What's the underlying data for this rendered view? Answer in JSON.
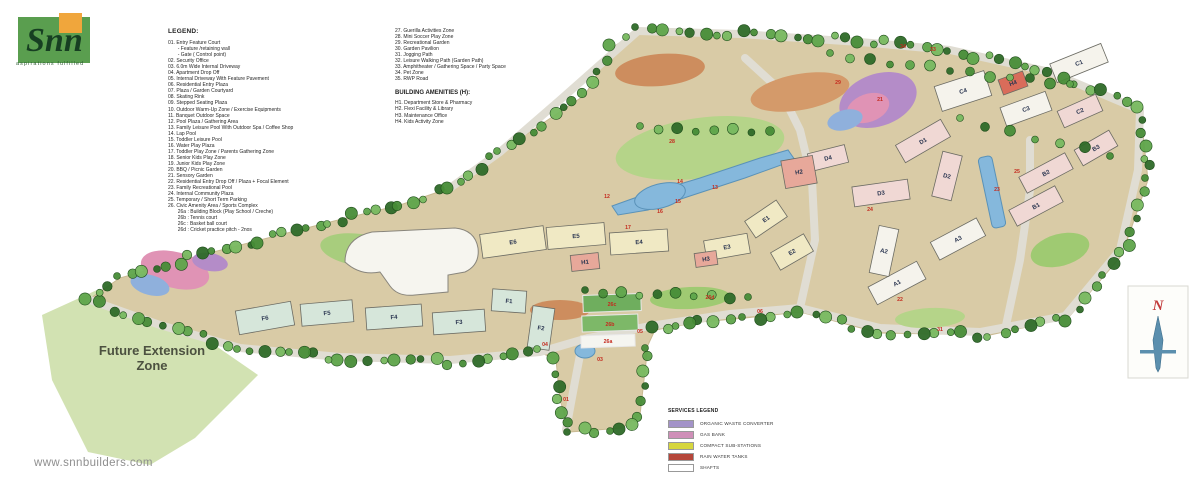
{
  "brand": {
    "name": "Snn",
    "tagline": "aspirations fulfilled",
    "website": "www.snnbuilders.com",
    "green": "#5a9e4f",
    "orange": "#f0a63c"
  },
  "legend": {
    "title": "LEGEND:",
    "col1": [
      "01. Entry Feature Court",
      "       - Feature /retaining wall",
      "       - Gate ( Control point)",
      "02. Security Office",
      "03. 6.0m Wide Internal Driveway",
      "04. Apartment Drop Off",
      "05. Internal Driveway With Feature Pavement",
      "06. Residential Entry Plaza",
      "07. Plaza / Garden Courtyard",
      "08. Skating Rink",
      "09. Stepped Seating Plaza",
      "10. Outdoor Warm-Up Zone / Exercise Equipments",
      "11. Banquet Outdoor Space",
      "12. Pool Plaza / Gathering Area",
      "13. Family Leisure Pool With Outdoor Spa / Coffee Shop",
      "14. Lap Pool",
      "15. Toddler Leisure Pool",
      "16. Water Play Plaza",
      "17. Toddler Play Zone / Parents Gathering Zone",
      "18. Senior Kids Play Zone",
      "19. Junior Kids Play Zone",
      "20. BBQ / Picnic Garden",
      "21. Sensory Garden",
      "22. Residential Entry Drop Off / Plaza + Focal Element",
      "23. Family Recreational Pool",
      "24. Internal Community Plaza",
      "25. Temporary / Short Term Parking",
      "26. Civic Amenity Area / Sports Complex",
      "       26a : Building Block (Play School / Creche)",
      "       26b : Tennis court",
      "       26c : Basket ball court",
      "       26d : Cricket practice pitch - 2nos"
    ],
    "col2": [
      "27. Guerilla Activities Zone",
      "28. Mini Soccer Play Zone",
      "29. Recreational Garden",
      "30. Garden Pavilion",
      "31. Jogging Path",
      "32. Leisure Walking Path (Garden Path)",
      "33. Amphitheater / Gathering Space / Party Space",
      "34. Pet Zone",
      "35. RWP Road"
    ],
    "amenities_title": "BUILDING AMENITIES (H):",
    "amenities": [
      "H1. Department Store & Pharmacy",
      "H2. Flexi Facility & Library",
      "H3. Maintenance Office",
      "H4. Kids Activity Zone"
    ]
  },
  "services_legend": {
    "title": "SERVICES LEGEND",
    "items": [
      {
        "label": "ORGANIC WASTE CONVERTER",
        "color": "#a393c8"
      },
      {
        "label": "GAS BANK",
        "color": "#cf8fb8"
      },
      {
        "label": "COMPACT SUB-STATIONS",
        "color": "#d6d63e"
      },
      {
        "label": "RAIN WATER TANKS",
        "color": "#b5463a"
      },
      {
        "label": "SHAFTS",
        "color": "#ffffff"
      }
    ]
  },
  "map": {
    "future_zone_label": [
      "Future Extension",
      "Zone"
    ],
    "north_label": "N",
    "colors": {
      "ground": "#d9cba6",
      "road": "#e0ddd3",
      "white": "#f5f3ec",
      "pink": "#f0d8d4",
      "cream": "#f0e9c4",
      "green": "#d6e6da",
      "salmon": "#e7a89a",
      "red": "#d96c5a",
      "pool": "#85b8dc",
      "poolEdge": "#5a92b8",
      "lawn": "#b5d489",
      "future": "#d2e2b2",
      "label": "#2a3550",
      "marker": "#c42a1e",
      "trees": [
        "#2e6a28",
        "#478c37",
        "#5ea44a",
        "#77b85f"
      ]
    },
    "site": [
      [
        638,
        30
      ],
      [
        730,
        33
      ],
      [
        860,
        40
      ],
      [
        950,
        50
      ],
      [
        1050,
        72
      ],
      [
        1140,
        108
      ],
      [
        1148,
        180
      ],
      [
        1122,
        255
      ],
      [
        1068,
        318
      ],
      [
        990,
        335
      ],
      [
        880,
        333
      ],
      [
        800,
        312
      ],
      [
        745,
        318
      ],
      [
        700,
        322
      ],
      [
        655,
        330
      ],
      [
        648,
        345
      ],
      [
        640,
        415
      ],
      [
        622,
        428
      ],
      [
        570,
        432
      ],
      [
        560,
        400
      ],
      [
        556,
        360
      ],
      [
        540,
        352
      ],
      [
        450,
        362
      ],
      [
        340,
        358
      ],
      [
        240,
        348
      ],
      [
        150,
        322
      ],
      [
        88,
        300
      ],
      [
        120,
        278
      ],
      [
        190,
        258
      ],
      [
        260,
        240
      ],
      [
        330,
        222
      ],
      [
        400,
        205
      ],
      [
        450,
        188
      ],
      [
        500,
        152
      ],
      [
        585,
        95
      ],
      [
        612,
        48
      ]
    ],
    "future_zone": [
      [
        97,
        290
      ],
      [
        200,
        335
      ],
      [
        258,
        375
      ],
      [
        195,
        438
      ],
      [
        150,
        465
      ],
      [
        88,
        452
      ],
      [
        52,
        380
      ],
      [
        42,
        315
      ]
    ],
    "roads": [
      "M566,430 L573,392 L580,355 L588,338",
      "M90,300 L160,325 L240,348 L340,357 L450,360 L540,352 L588,338",
      "M588,338 L650,326 L730,314 L800,308 L880,328 L980,332 L1065,316",
      "M1065,316 L1120,250 L1138,170 L1140,110",
      "M1140,110 L1050,72 L950,50 L860,42 L740,34 L638,31",
      "M638,31 L560,100 L500,152 L450,188",
      "M800,308 L815,240 L812,180 L800,130 L780,90 L745,58",
      "M1005,330 L1020,260 L1030,190 L1030,140"
    ],
    "patches": [
      {
        "x": 700,
        "y": 148,
        "rx": 85,
        "ry": 30,
        "rot": -8,
        "c": "#b5d489"
      },
      {
        "x": 660,
        "y": 70,
        "rx": 45,
        "ry": 16,
        "rot": -5,
        "c": "#cd8d5e"
      },
      {
        "x": 800,
        "y": 92,
        "rx": 50,
        "ry": 18,
        "rot": -10,
        "c": "#d49a6a"
      },
      {
        "x": 560,
        "y": 310,
        "rx": 30,
        "ry": 10,
        "rot": 0,
        "c": "#cd8d5e"
      },
      {
        "x": 878,
        "y": 100,
        "rx": 40,
        "ry": 26,
        "rot": -20,
        "c": "#b48cc8"
      },
      {
        "x": 868,
        "y": 108,
        "rx": 22,
        "ry": 14,
        "rot": -20,
        "c": "#e093b5"
      },
      {
        "x": 845,
        "y": 120,
        "rx": 18,
        "ry": 10,
        "rot": -15,
        "c": "#8fb0dc"
      },
      {
        "x": 175,
        "y": 270,
        "rx": 35,
        "ry": 18,
        "rot": 15,
        "c": "#e093b5"
      },
      {
        "x": 150,
        "y": 285,
        "rx": 20,
        "ry": 10,
        "rot": 15,
        "c": "#8fb0dc"
      },
      {
        "x": 210,
        "y": 262,
        "rx": 18,
        "ry": 9,
        "rot": 10,
        "c": "#b48cc8"
      },
      {
        "x": 442,
        "y": 243,
        "rx": 25,
        "ry": 12,
        "rot": -10,
        "c": "#ecaf4a"
      },
      {
        "x": 690,
        "y": 298,
        "rx": 40,
        "ry": 11,
        "rot": -3,
        "c": "#9fca72"
      },
      {
        "x": 930,
        "y": 318,
        "rx": 35,
        "ry": 10,
        "rot": -3,
        "c": "#b5d489"
      },
      {
        "x": 1060,
        "y": 250,
        "rx": 30,
        "ry": 16,
        "rot": -15,
        "c": "#9fca72"
      },
      {
        "x": 360,
        "y": 250,
        "rx": 40,
        "ry": 16,
        "rot": 8,
        "c": "#a8cd7d"
      }
    ],
    "pools": [
      {
        "pts": [
          [
            612,
            206
          ],
          [
            640,
            196
          ],
          [
            700,
            178
          ],
          [
            760,
            158
          ],
          [
            788,
            150
          ],
          [
            795,
            160
          ],
          [
            745,
            178
          ],
          [
            690,
            196
          ],
          [
            648,
            210
          ],
          [
            618,
            215
          ]
        ]
      },
      {
        "ell": {
          "x": 660,
          "y": 196,
          "rx": 26,
          "ry": 12,
          "rot": -15
        }
      },
      {
        "rect": {
          "x": 992,
          "y": 192,
          "w": 14,
          "h": 72,
          "rot": -12
        }
      },
      {
        "ell": {
          "x": 585,
          "y": 351,
          "rx": 10,
          "ry": 7,
          "rot": 0
        }
      }
    ],
    "courts": [
      {
        "x": 612,
        "y": 303,
        "w": 58,
        "h": 17,
        "rot": -2,
        "c": "#6fae5e"
      },
      {
        "x": 610,
        "y": 323,
        "w": 56,
        "h": 16,
        "rot": -2,
        "c": "#7db868"
      },
      {
        "x": 608,
        "y": 341,
        "w": 54,
        "h": 12,
        "rot": -2,
        "c": "#f5f5f0"
      }
    ],
    "clubhouse_path": "M345,262 Q345,238 372,232 L455,228 Q475,230 478,248 Q480,265 465,272 L448,275 L448,292 L415,295 Q398,297 390,286 L380,272 Q360,276 345,262 Z",
    "buildings": [
      {
        "label": "A1",
        "x": 897,
        "y": 283,
        "w": 55,
        "h": 20,
        "r": -28,
        "c": "white"
      },
      {
        "label": "A2",
        "x": 884,
        "y": 251,
        "w": 20,
        "h": 48,
        "r": 12,
        "c": "white"
      },
      {
        "label": "A3",
        "x": 958,
        "y": 239,
        "w": 52,
        "h": 20,
        "r": -28,
        "c": "white"
      },
      {
        "label": "B1",
        "x": 1036,
        "y": 206,
        "w": 52,
        "h": 18,
        "r": -28,
        "c": "pink"
      },
      {
        "label": "B2",
        "x": 1046,
        "y": 173,
        "w": 52,
        "h": 18,
        "r": -28,
        "c": "pink"
      },
      {
        "label": "B3",
        "x": 1096,
        "y": 148,
        "w": 40,
        "h": 18,
        "r": -30,
        "c": "pink"
      },
      {
        "label": "C1",
        "x": 1079,
        "y": 63,
        "w": 55,
        "h": 20,
        "r": -22,
        "c": "white"
      },
      {
        "label": "C2",
        "x": 1080,
        "y": 111,
        "w": 42,
        "h": 18,
        "r": -24,
        "c": "pink"
      },
      {
        "label": "C3",
        "x": 1026,
        "y": 109,
        "w": 48,
        "h": 20,
        "r": -20,
        "c": "white"
      },
      {
        "label": "C4",
        "x": 963,
        "y": 91,
        "w": 52,
        "h": 26,
        "r": -18,
        "c": "white"
      },
      {
        "label": "D1",
        "x": 923,
        "y": 141,
        "w": 52,
        "h": 20,
        "r": -30,
        "c": "pink"
      },
      {
        "label": "D2",
        "x": 947,
        "y": 176,
        "w": 20,
        "h": 46,
        "r": 14,
        "c": "pink"
      },
      {
        "label": "D3",
        "x": 881,
        "y": 193,
        "w": 56,
        "h": 20,
        "r": -8,
        "c": "pink"
      },
      {
        "label": "D4",
        "x": 828,
        "y": 158,
        "w": 38,
        "h": 18,
        "r": -14,
        "c": "pink"
      },
      {
        "label": "E1",
        "x": 766,
        "y": 219,
        "w": 38,
        "h": 20,
        "r": -34,
        "c": "cream"
      },
      {
        "label": "E2",
        "x": 792,
        "y": 252,
        "w": 38,
        "h": 20,
        "r": -30,
        "c": "cream"
      },
      {
        "label": "E3",
        "x": 727,
        "y": 247,
        "w": 44,
        "h": 20,
        "r": -10,
        "c": "cream"
      },
      {
        "label": "E4",
        "x": 639,
        "y": 242,
        "w": 58,
        "h": 22,
        "r": -4,
        "c": "cream"
      },
      {
        "label": "E5",
        "x": 576,
        "y": 236,
        "w": 58,
        "h": 22,
        "r": -5,
        "c": "cream"
      },
      {
        "label": "E6",
        "x": 513,
        "y": 242,
        "w": 64,
        "h": 24,
        "r": -8,
        "c": "cream"
      },
      {
        "label": "F1",
        "x": 509,
        "y": 301,
        "w": 34,
        "h": 22,
        "r": 4,
        "c": "green"
      },
      {
        "label": "F2",
        "x": 541,
        "y": 328,
        "w": 22,
        "h": 42,
        "r": 8,
        "c": "green"
      },
      {
        "label": "F3",
        "x": 459,
        "y": 322,
        "w": 52,
        "h": 22,
        "r": -4,
        "c": "green"
      },
      {
        "label": "F4",
        "x": 394,
        "y": 317,
        "w": 56,
        "h": 22,
        "r": -4,
        "c": "green"
      },
      {
        "label": "F5",
        "x": 327,
        "y": 313,
        "w": 52,
        "h": 22,
        "r": -5,
        "c": "green"
      },
      {
        "label": "F6",
        "x": 265,
        "y": 318,
        "w": 56,
        "h": 24,
        "r": -10,
        "c": "green"
      },
      {
        "label": "H1",
        "x": 585,
        "y": 262,
        "w": 28,
        "h": 16,
        "r": -6,
        "c": "salmon"
      },
      {
        "label": "H2",
        "x": 799,
        "y": 172,
        "w": 32,
        "h": 28,
        "r": -10,
        "c": "salmon"
      },
      {
        "label": "H3",
        "x": 706,
        "y": 259,
        "w": 22,
        "h": 14,
        "r": -8,
        "c": "salmon"
      },
      {
        "label": "H4",
        "x": 1013,
        "y": 83,
        "w": 26,
        "h": 16,
        "r": -20,
        "c": "red"
      }
    ],
    "markers": [
      {
        "label": "01",
        "x": 566,
        "y": 401
      },
      {
        "label": "03",
        "x": 600,
        "y": 361
      },
      {
        "label": "04",
        "x": 545,
        "y": 346
      },
      {
        "label": "05",
        "x": 640,
        "y": 333
      },
      {
        "label": "06",
        "x": 760,
        "y": 313
      },
      {
        "label": "12",
        "x": 607,
        "y": 198
      },
      {
        "label": "13",
        "x": 715,
        "y": 189
      },
      {
        "label": "14",
        "x": 680,
        "y": 183
      },
      {
        "label": "15",
        "x": 678,
        "y": 203
      },
      {
        "label": "16",
        "x": 660,
        "y": 213
      },
      {
        "label": "17",
        "x": 628,
        "y": 229
      },
      {
        "label": "21",
        "x": 880,
        "y": 101
      },
      {
        "label": "22",
        "x": 900,
        "y": 301
      },
      {
        "label": "23",
        "x": 997,
        "y": 191
      },
      {
        "label": "24",
        "x": 870,
        "y": 211
      },
      {
        "label": "25",
        "x": 1017,
        "y": 173
      },
      {
        "label": "26a",
        "x": 608,
        "y": 343
      },
      {
        "label": "26b",
        "x": 610,
        "y": 326
      },
      {
        "label": "26c",
        "x": 612,
        "y": 306
      },
      {
        "label": "26d",
        "x": 710,
        "y": 299
      },
      {
        "label": "28",
        "x": 672,
        "y": 143
      },
      {
        "label": "29",
        "x": 838,
        "y": 84
      },
      {
        "label": "31",
        "x": 940,
        "y": 331
      },
      {
        "label": "33",
        "x": 933,
        "y": 51
      },
      {
        "label": "34",
        "x": 903,
        "y": 48
      }
    ],
    "treelines": [
      {
        "x1": 585,
        "y1": 292,
        "x2": 748,
        "y2": 297,
        "n": 10
      },
      {
        "x1": 640,
        "y1": 128,
        "x2": 770,
        "y2": 132,
        "n": 8
      },
      {
        "x1": 830,
        "y1": 55,
        "x2": 1070,
        "y2": 85,
        "n": 13
      },
      {
        "x1": 960,
        "y1": 120,
        "x2": 1110,
        "y2": 155,
        "n": 7
      }
    ]
  }
}
